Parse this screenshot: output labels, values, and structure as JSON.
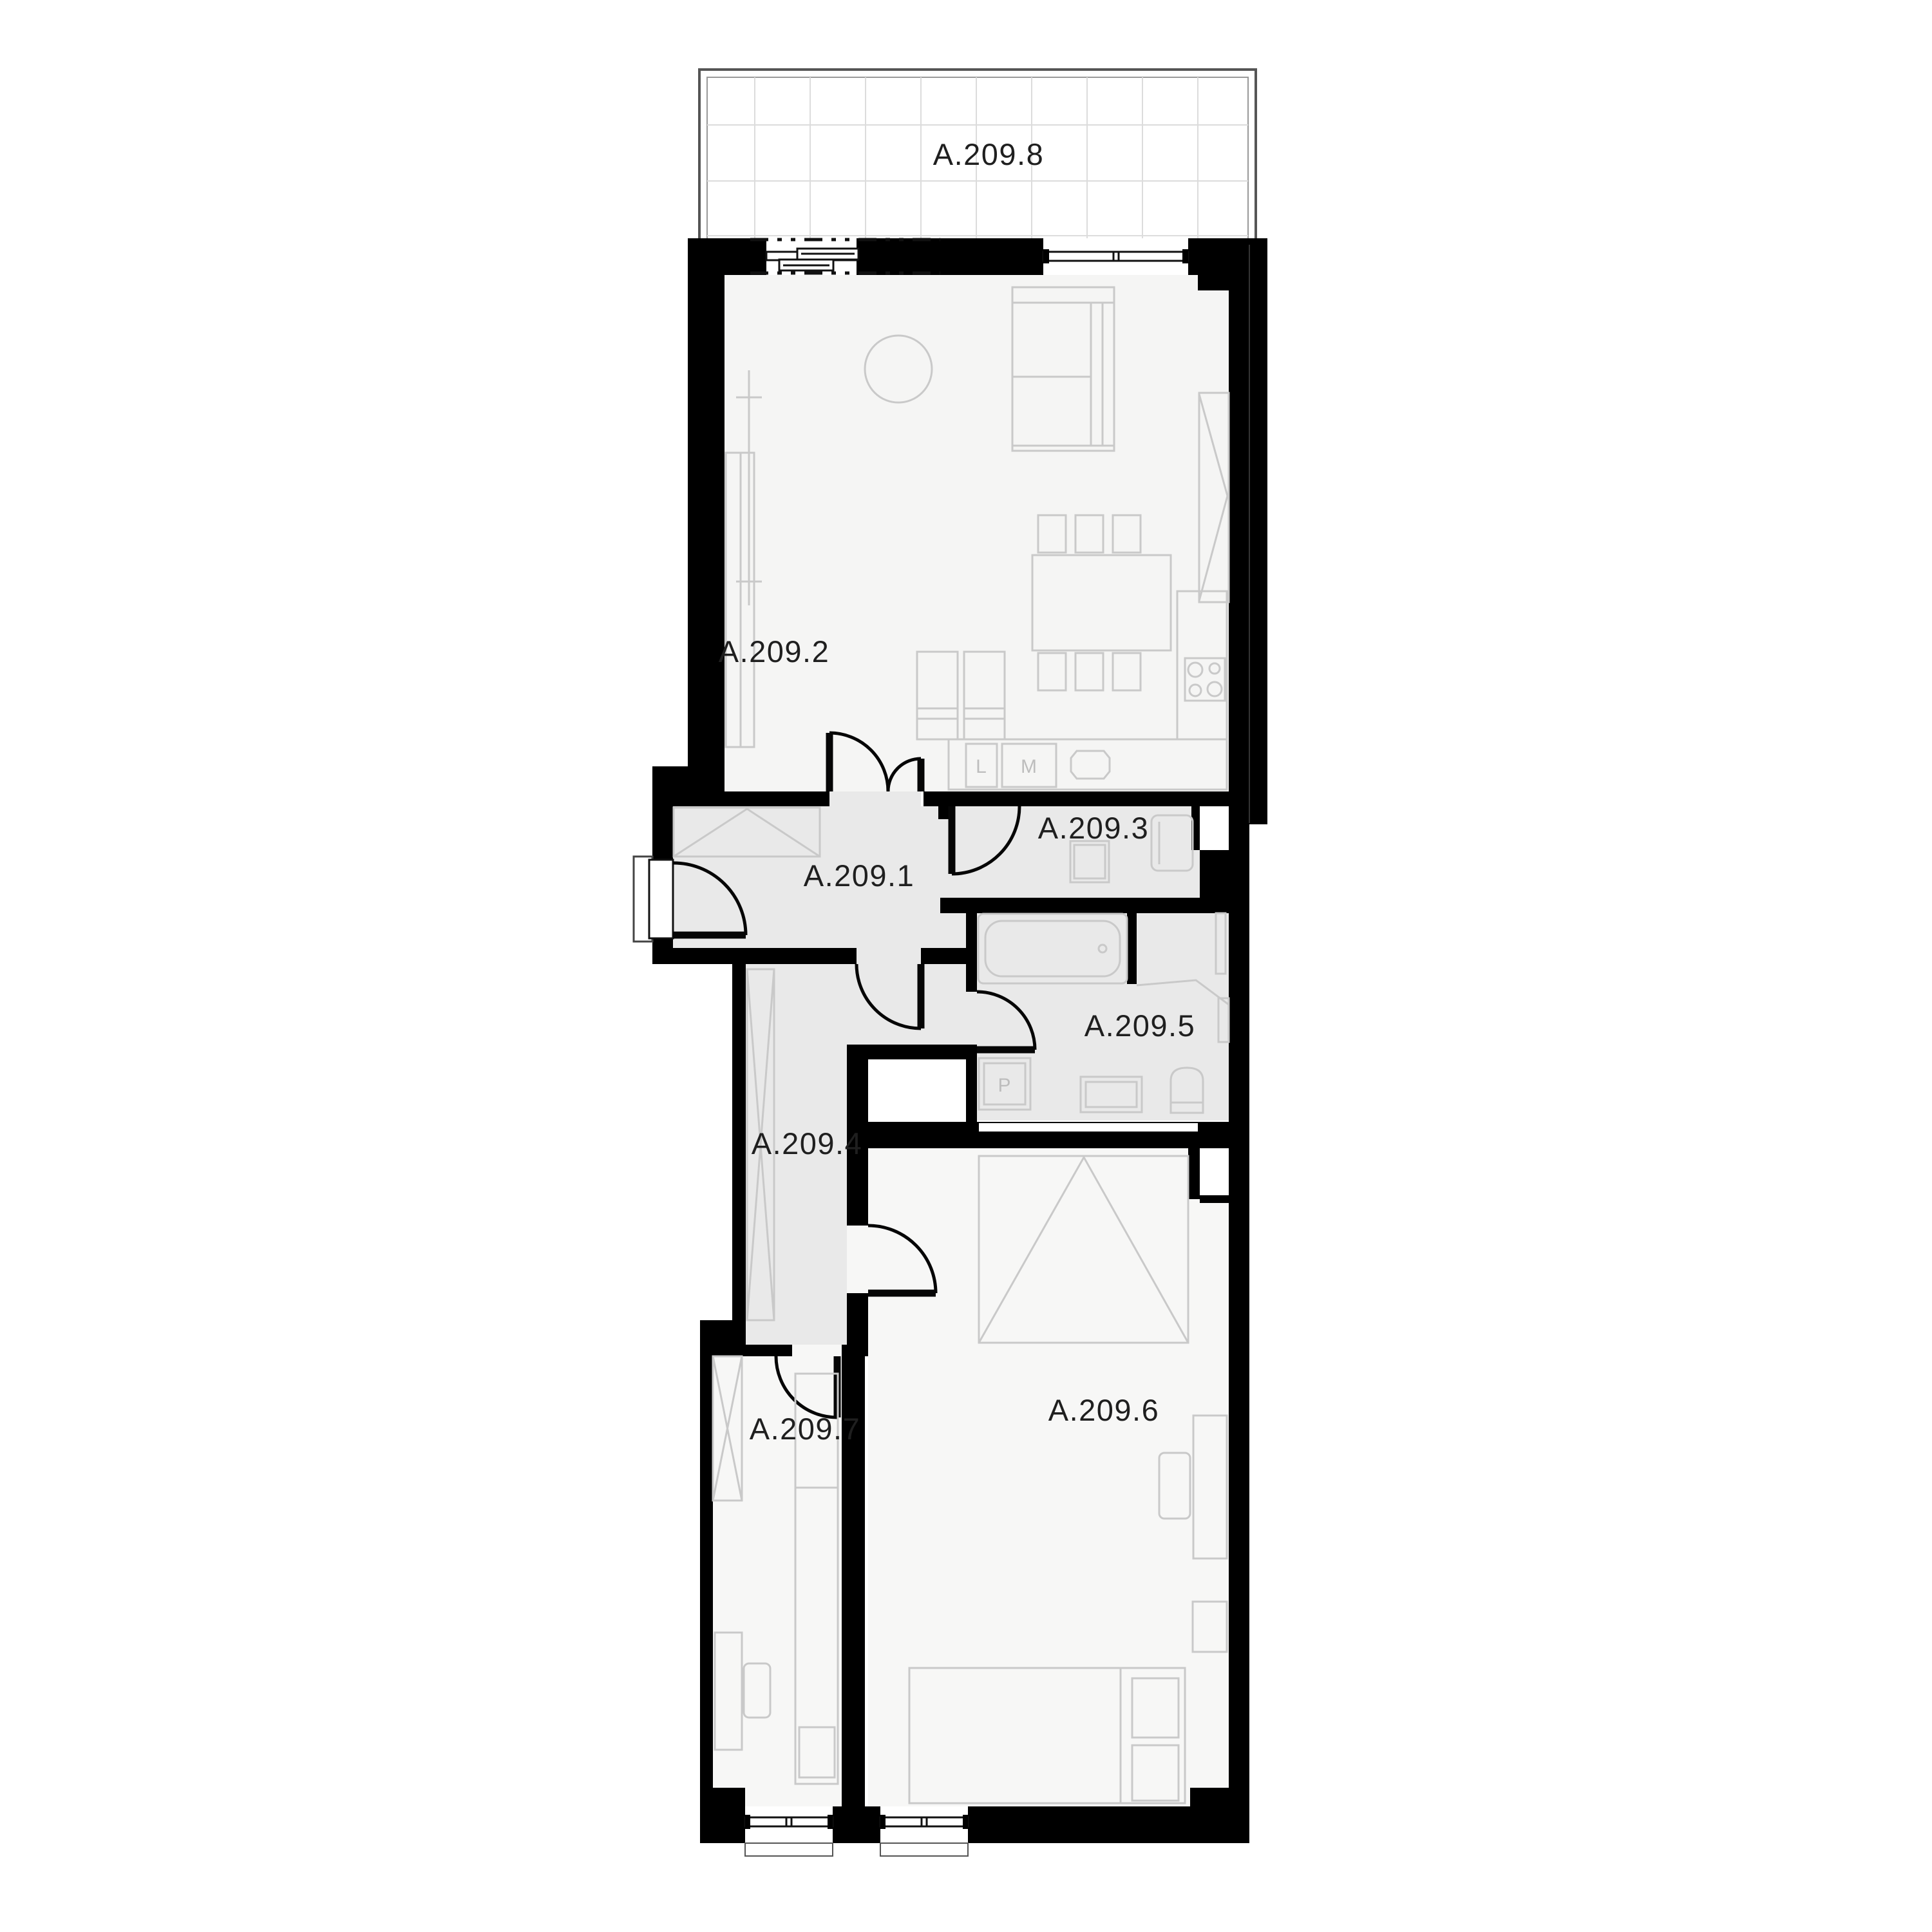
{
  "plan": {
    "unit_prefix": "A.209",
    "rooms": [
      {
        "label": "A.209.1"
      },
      {
        "label": "A.209.2"
      },
      {
        "label": "A.209.3"
      },
      {
        "label": "A.209.4"
      },
      {
        "label": "A.209.5"
      },
      {
        "label": "A.209.6"
      },
      {
        "label": "A.209.7"
      },
      {
        "label": "A.209.8"
      }
    ],
    "appliance_labels": {
      "kitchen_left": "L",
      "kitchen_right": "M",
      "bathroom_washer": "P"
    },
    "colors": {
      "wall": "#000000",
      "hall_floor": "#e9e9e9",
      "living_floor": "#f5f5f4",
      "bedroom_floor": "#f7f7f6",
      "furniture_line": "#c9c9c9",
      "terrace_grid": "#dcdcdc"
    }
  }
}
